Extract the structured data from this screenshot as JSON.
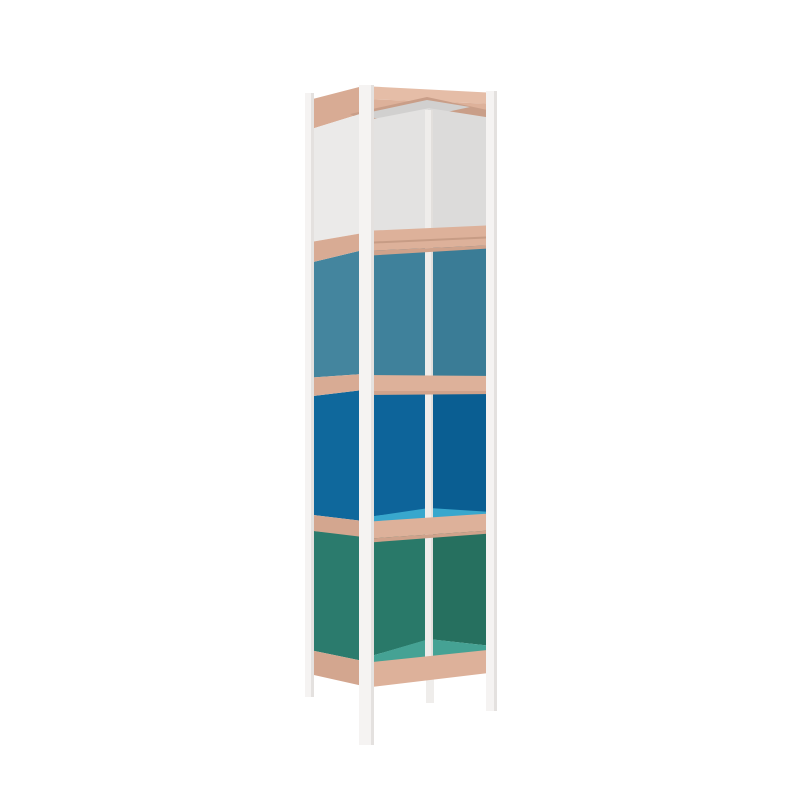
{
  "scene": {
    "description": "3D product render of a tall narrow four-tier open shelving unit with a slim white metal frame, raw plywood shelf edges, and colored panels on a plain white background",
    "object": "column-shelf-unit",
    "background": "#ffffff"
  },
  "colors": {
    "post_white": "#f5f3f2",
    "post_shade": "#e4e1df",
    "post_inner": "#efedeb",
    "post_inner_shade": "#e2dfdc",
    "wood_top": "#e5bda7",
    "wood_front": "#ddb19a",
    "wood_side": "#d8ab94",
    "wood_side_low": "#d3a68f",
    "wood_inner": "#c99e88",
    "wood_under": "#cfa28b",
    "wood_crease": "#c79c85",
    "tier1_left": "#ebeae9",
    "tier1_back_left": "#e3e2e1",
    "tier1_back_right": "#dcdbda",
    "tier1_top": "#d1d0cf",
    "tier2_left": "#44859e",
    "tier2_back_left": "#3f819b",
    "tier2_back_right": "#3a7c96",
    "tier3_left": "#0f689c",
    "tier3_back_left": "#0d649a",
    "tier3_back_right": "#0a5e92",
    "tier3_shelf": "#38a7cd",
    "tier4_left": "#2b7b6d",
    "tier4_back_left": "#297969",
    "tier4_back_right": "#26705f",
    "tier4_floor": "#45a294"
  },
  "tiers": [
    {
      "label": "tier-1-top",
      "panel_finish": "white-grey"
    },
    {
      "label": "tier-2",
      "panel_finish": "steel-blue"
    },
    {
      "label": "tier-3",
      "panel_finish": "ocean-blue"
    },
    {
      "label": "tier-4-bottom",
      "panel_finish": "teal-green"
    }
  ]
}
